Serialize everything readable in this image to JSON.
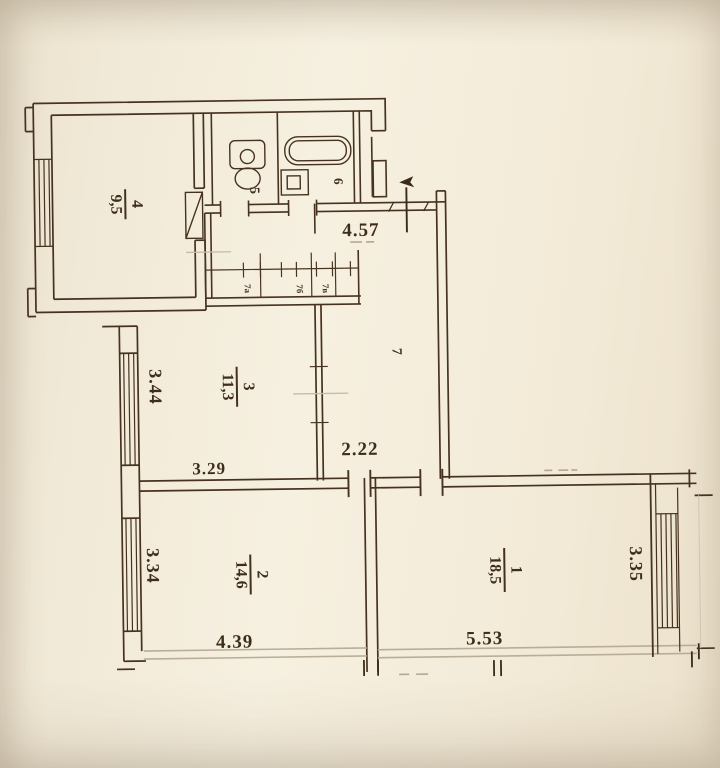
{
  "plan": {
    "type": "apartment-floor-plan",
    "rooms": {
      "r1": {
        "number": "1",
        "area": "18,5"
      },
      "r2": {
        "number": "2",
        "area": "14,6"
      },
      "r3": {
        "number": "3",
        "area": "11,3"
      },
      "r4": {
        "number": "4",
        "area": "9,5"
      },
      "r5": {
        "number": "5"
      },
      "r6": {
        "number": "6"
      },
      "r7": {
        "number": "7"
      }
    },
    "closets": {
      "a": "7а",
      "b": "7б",
      "c": "7в"
    },
    "dimensions": {
      "hall_top_width": "4.57",
      "room3_depth": "3.44",
      "room3_width": "3.29",
      "corridor_width": "2.22",
      "room2_depth": "3.34",
      "room2_width": "4.39",
      "room1_width": "5.53",
      "room1_depth": "3.35"
    },
    "colors": {
      "paper": "#f3ecdb",
      "ink": "#46321f",
      "ink_dark": "#392a1c",
      "gray_line": "#b9ad97",
      "faint": "#c6bba6"
    }
  }
}
